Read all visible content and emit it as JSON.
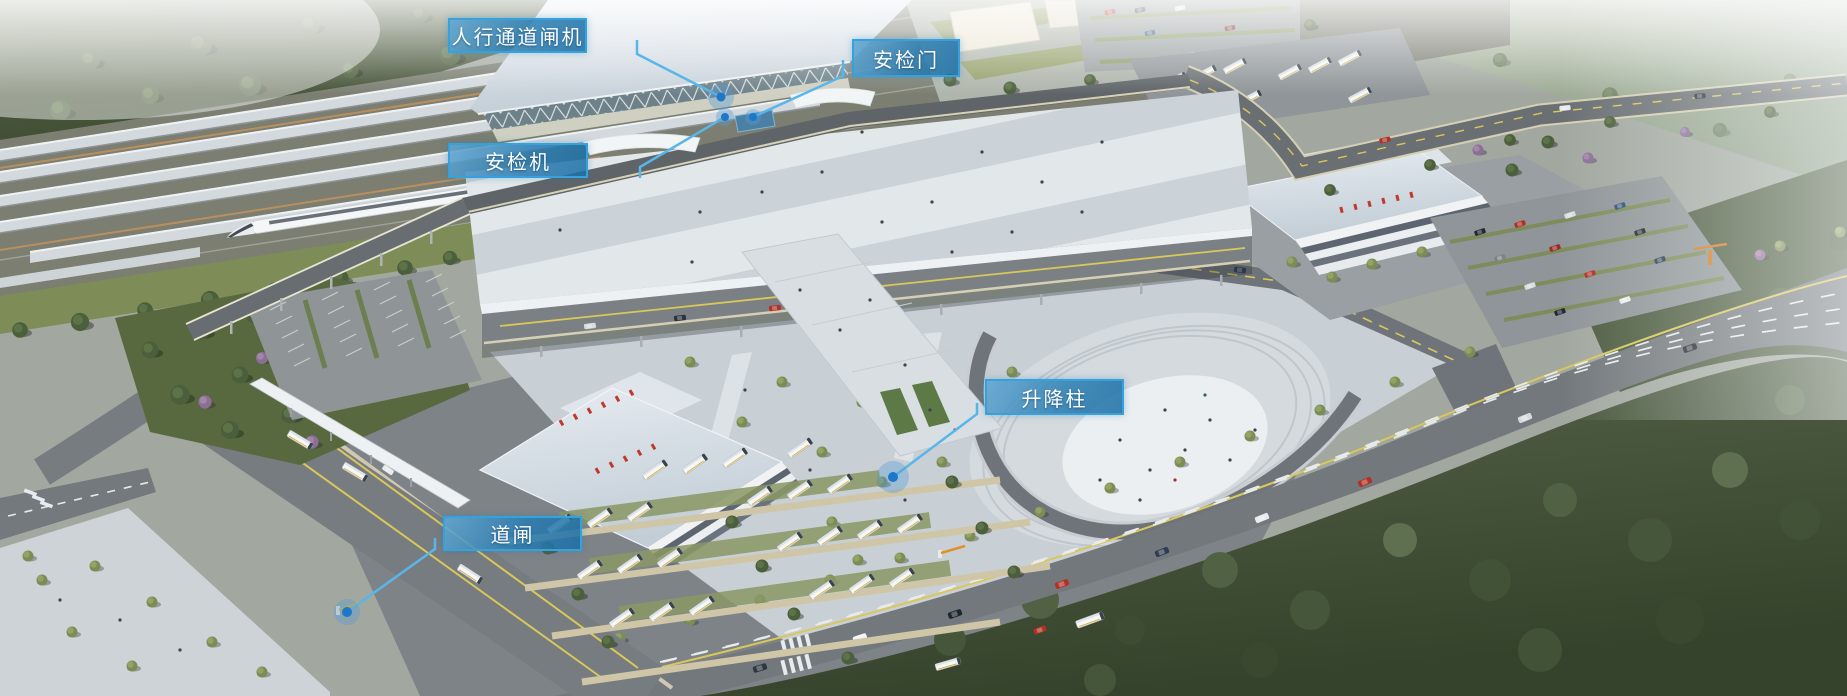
{
  "canvas": {
    "width": 1847,
    "height": 696
  },
  "colors": {
    "label_border": "#35a2dd",
    "label_text": "#ffffff",
    "leader_line": "#58b6e8",
    "marker_dot": "#1d78c9",
    "marker_halo": "rgba(88,156,214,0.38)"
  },
  "annotations": [
    {
      "id": "pedestrian-channel-gate",
      "label": "人行通道闸机",
      "box": {
        "x": 448,
        "y": 18,
        "w": 139,
        "h": 35
      },
      "leader_points": "637,40 637,54 721,97",
      "marker": {
        "x": 721,
        "y": 97,
        "r": 4.5,
        "halo_r": 13
      }
    },
    {
      "id": "security-check-door",
      "label": "安检门",
      "box": {
        "x": 852,
        "y": 39,
        "w": 108,
        "h": 38
      },
      "leader_points": "843,60 843,76 753,117",
      "marker": {
        "x": 753,
        "y": 117,
        "r": 4,
        "halo_r": 8
      }
    },
    {
      "id": "security-scanner-machine",
      "label": "安检机",
      "box": {
        "x": 448,
        "y": 143,
        "w": 140,
        "h": 35
      },
      "leader_points": "640,178 640,167 725,117",
      "marker": {
        "x": 725,
        "y": 117,
        "r": 4,
        "halo_r": 9
      }
    },
    {
      "id": "rising-bollard",
      "label": "升降柱",
      "box": {
        "x": 985,
        "y": 379,
        "w": 139,
        "h": 36
      },
      "leader_points": "977,403 977,414 893,477",
      "marker": {
        "x": 893,
        "y": 477,
        "r": 5,
        "halo_r": 16
      }
    },
    {
      "id": "road-barrier-gate",
      "label": "道闸",
      "box": {
        "x": 443,
        "y": 516,
        "w": 139,
        "h": 35
      },
      "leader_points": "435,538 435,549 347,612",
      "marker": {
        "x": 347,
        "y": 612,
        "r": 5,
        "halo_r": 13
      }
    }
  ]
}
